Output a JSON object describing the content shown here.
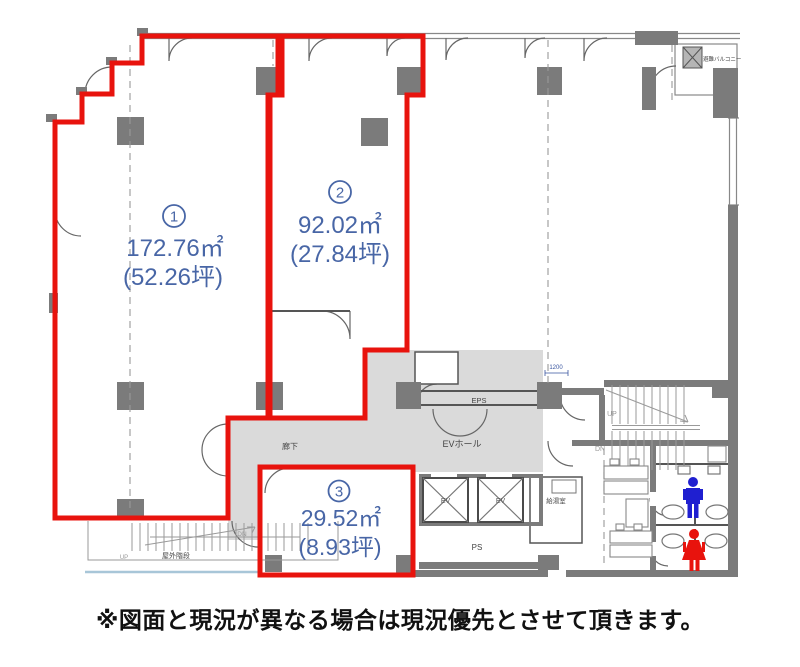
{
  "caption": "※図面と現況が異なる場合は現況優先とさせて頂きます。",
  "units": [
    {
      "circled_number": "1",
      "area_sqm": "172.76㎡",
      "area_tsubo": "(52.26坪)"
    },
    {
      "circled_number": "2",
      "area_sqm": "92.02㎡",
      "area_tsubo": "(27.84坪)"
    },
    {
      "circled_number": "3",
      "area_sqm": "29.52㎡",
      "area_tsubo": "(8.93坪)"
    }
  ],
  "labels": {
    "eps": "EPS",
    "ev_hall": "EVホール",
    "corridor": "廊下",
    "ps": "PS",
    "kitchenette": "給湯室",
    "outdoor_stairs": "屋外階段",
    "evacuation_balcony": "避難バルコニー",
    "elevator_1": "EV",
    "elevator_2": "EV",
    "stairs_up": "UP",
    "stairs_down": "DN",
    "outdoor_up": "UP",
    "corridor_down": "DN",
    "dimension": "1200"
  },
  "colors": {
    "unit_outline_red": "#e8130d",
    "area_text_blue": "#4866a6",
    "wall_dark_gray": "#7b7b7b",
    "common_area_fill": "#dadada",
    "mens_icon_blue": "#1f1fd0",
    "womens_icon_red": "#e8130d",
    "thin_line_gray": "#5a5a5a",
    "dimension_blue": "#3a56a0",
    "eave_line_blue": "#a8c6d8"
  }
}
